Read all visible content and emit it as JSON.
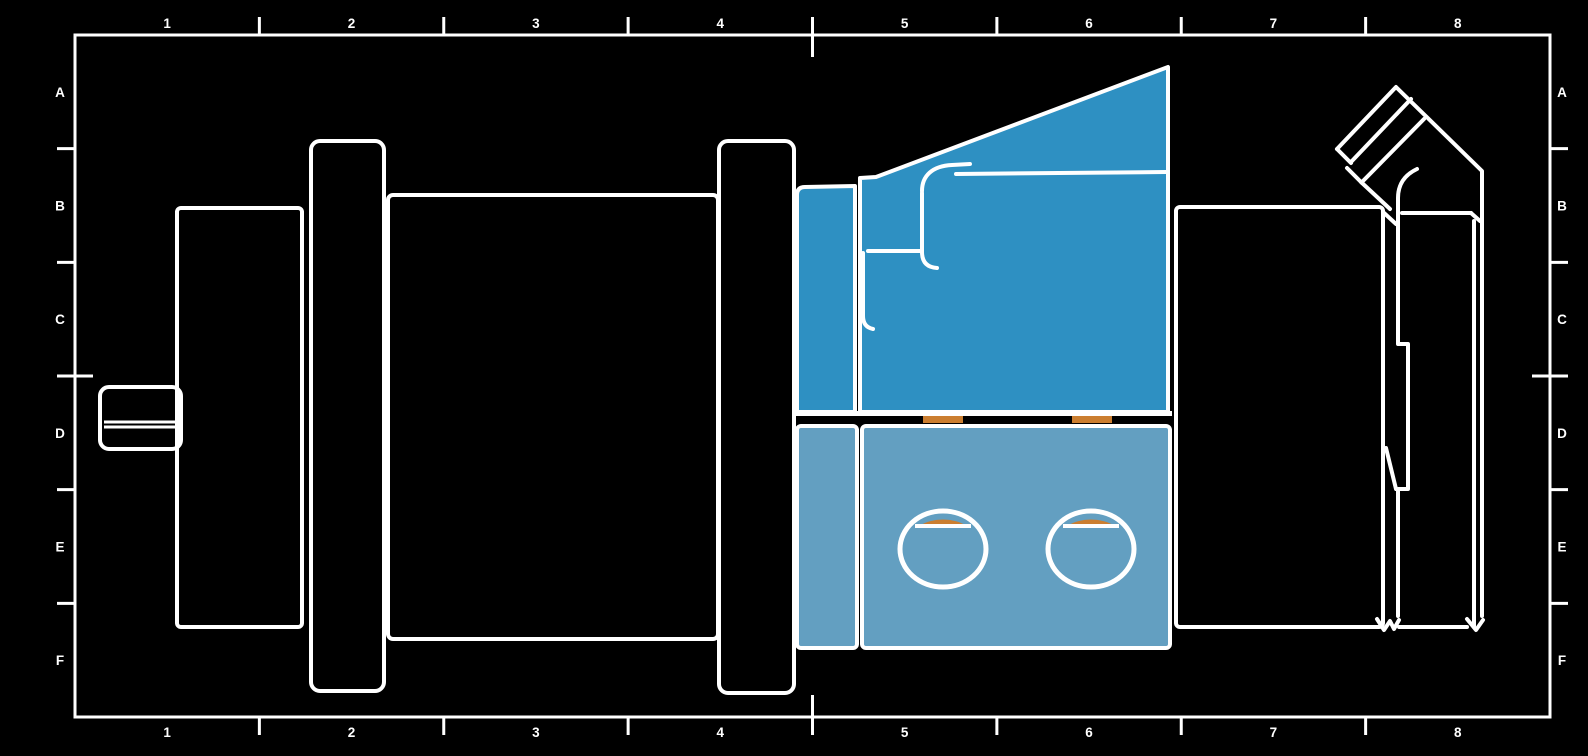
{
  "sheet": {
    "background": "#000000",
    "line_color": "#ffffff",
    "grid": {
      "columns": [
        "1",
        "2",
        "3",
        "4",
        "5",
        "6",
        "7",
        "8"
      ],
      "rows": [
        "A",
        "B",
        "C",
        "D",
        "E",
        "F"
      ]
    }
  },
  "part_colors": {
    "valve_body_blue": "#2e90c2",
    "manifold_light_blue": "#639fc1",
    "seal_orange": "#cb7e30"
  }
}
